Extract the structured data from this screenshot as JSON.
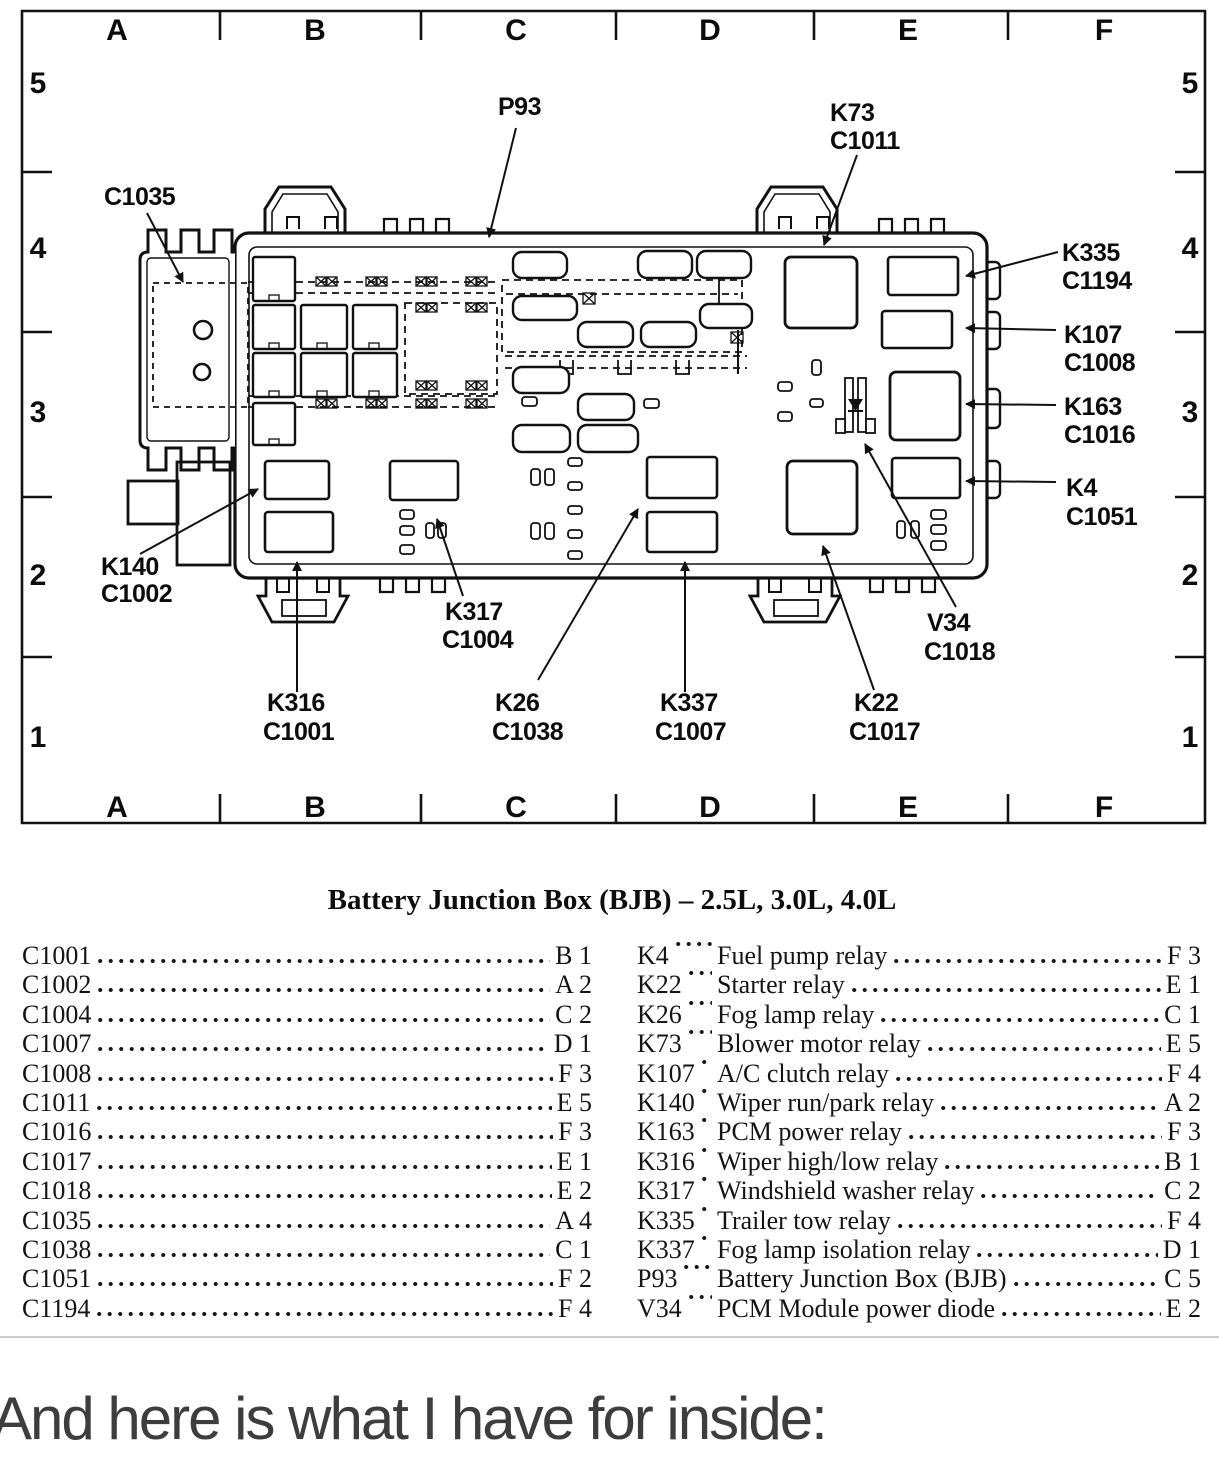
{
  "colors": {
    "ink": "#111111",
    "footer_text": "#3d3d3d",
    "separator": "#c9c9c9"
  },
  "diagram": {
    "grid": {
      "columns": [
        "A",
        "B",
        "C",
        "D",
        "E",
        "F"
      ],
      "rows": [
        "5",
        "4",
        "3",
        "2",
        "1"
      ]
    },
    "callouts": [
      {
        "id": "P93",
        "line1": "P93",
        "line2": ""
      },
      {
        "id": "C1035",
        "line1": "C1035",
        "line2": ""
      },
      {
        "id": "K73",
        "line1": "K73",
        "line2": "C1011"
      },
      {
        "id": "K335",
        "line1": "K335",
        "line2": "C1194"
      },
      {
        "id": "K107",
        "line1": "K107",
        "line2": "C1008"
      },
      {
        "id": "K163",
        "line1": "K163",
        "line2": "C1016"
      },
      {
        "id": "K4",
        "line1": "K4",
        "line2": "C1051"
      },
      {
        "id": "K140",
        "line1": "K140",
        "line2": "C1002"
      },
      {
        "id": "K316",
        "line1": "K316",
        "line2": "C1001"
      },
      {
        "id": "K317",
        "line1": "K317",
        "line2": "C1004"
      },
      {
        "id": "K26",
        "line1": "K26",
        "line2": "C1038"
      },
      {
        "id": "K337",
        "line1": "K337",
        "line2": "C1007"
      },
      {
        "id": "K22",
        "line1": "K22",
        "line2": "C1017"
      },
      {
        "id": "V34",
        "line1": "V34",
        "line2": "C1018"
      }
    ]
  },
  "table": {
    "title": "Battery Junction Box (BJB) – 2.5L, 3.0L, 4.0L",
    "connectors": [
      {
        "id": "C1001",
        "ref": "B 1"
      },
      {
        "id": "C1002",
        "ref": "A 2"
      },
      {
        "id": "C1004",
        "ref": "C 2"
      },
      {
        "id": "C1007",
        "ref": "D 1"
      },
      {
        "id": "C1008",
        "ref": "F 3"
      },
      {
        "id": "C1011",
        "ref": "E 5"
      },
      {
        "id": "C1016",
        "ref": "F 3"
      },
      {
        "id": "C1017",
        "ref": "E 1"
      },
      {
        "id": "C1018",
        "ref": "E 2"
      },
      {
        "id": "C1035",
        "ref": "A 4"
      },
      {
        "id": "C1038",
        "ref": "C 1"
      },
      {
        "id": "C1051",
        "ref": "F 2"
      },
      {
        "id": "C1194",
        "ref": "F 4"
      }
    ],
    "components": [
      {
        "id": "K4",
        "name": "Fuel pump relay",
        "ref": "F 3"
      },
      {
        "id": "K22",
        "name": "Starter relay",
        "ref": "E 1"
      },
      {
        "id": "K26",
        "name": "Fog lamp relay",
        "ref": "C 1"
      },
      {
        "id": "K73",
        "name": "Blower motor relay",
        "ref": "E 5"
      },
      {
        "id": "K107",
        "name": "A/C clutch relay",
        "ref": "F 4"
      },
      {
        "id": "K140",
        "name": "Wiper run/park relay",
        "ref": "A 2"
      },
      {
        "id": "K163",
        "name": "PCM power relay",
        "ref": "F 3"
      },
      {
        "id": "K316",
        "name": "Wiper high/low relay",
        "ref": "B 1"
      },
      {
        "id": "K317",
        "name": "Windshield washer relay",
        "ref": "C 2"
      },
      {
        "id": "K335",
        "name": "Trailer tow relay",
        "ref": "F 4"
      },
      {
        "id": "K337",
        "name": "Fog lamp isolation relay",
        "ref": "D 1"
      },
      {
        "id": "P93",
        "name": "Battery Junction Box (BJB)",
        "ref": "C 5"
      },
      {
        "id": "V34",
        "name": "PCM Module power diode",
        "ref": "E 2"
      }
    ]
  },
  "footer": {
    "text": "And here is what I have for inside:"
  }
}
